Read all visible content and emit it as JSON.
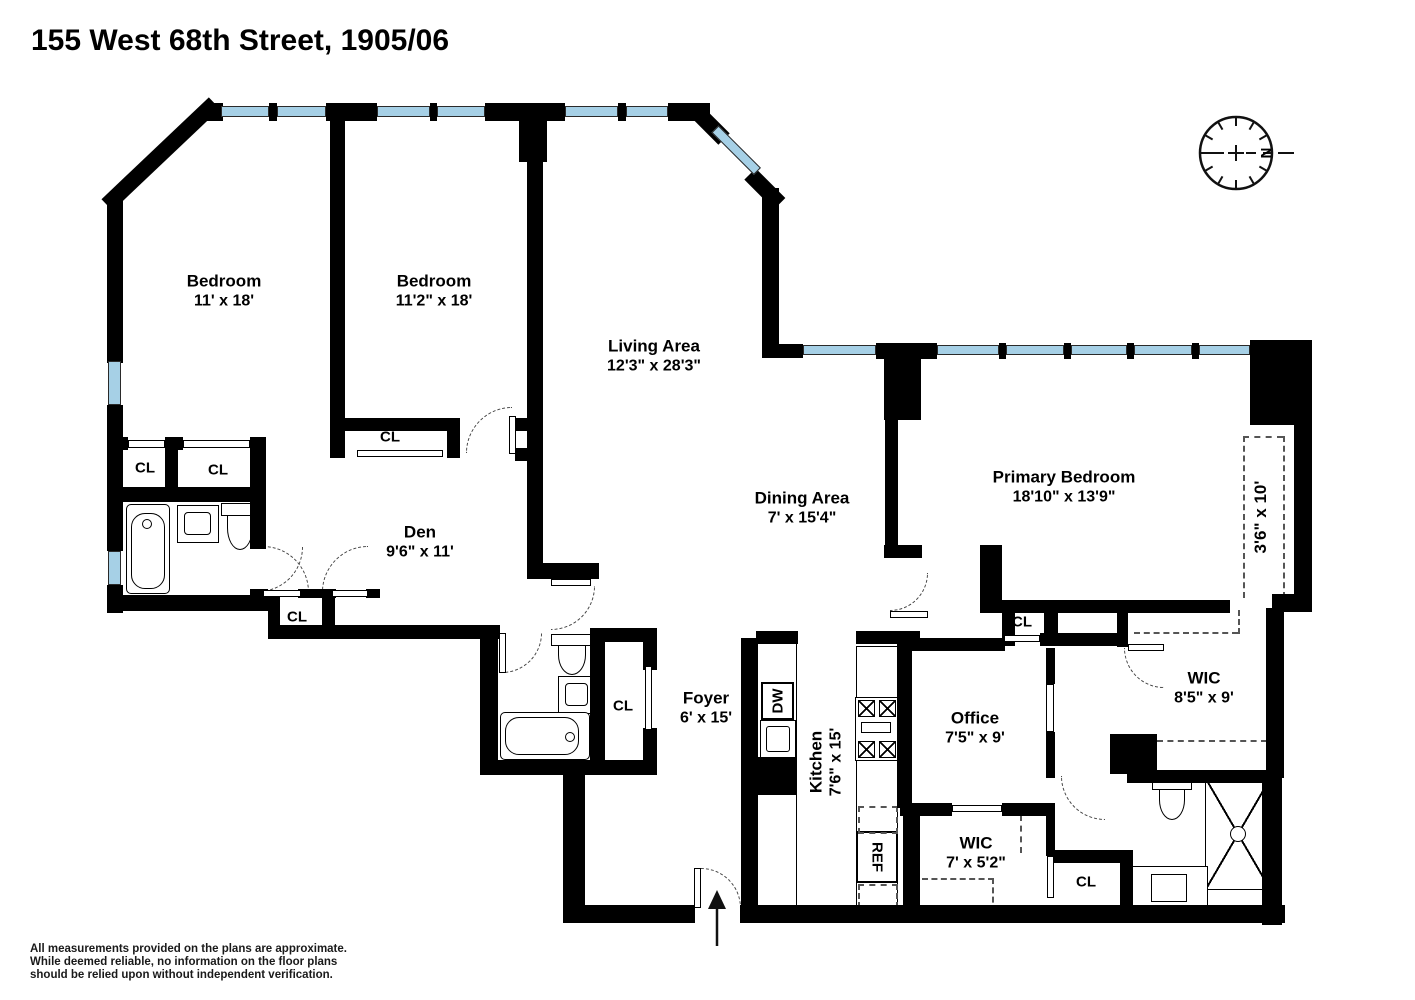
{
  "title": "155 West 68th Street, 1905/06",
  "compass": {
    "north_label": "N"
  },
  "rooms": {
    "bedroom1": {
      "name": "Bedroom",
      "dims": "11' x 18'"
    },
    "bedroom2": {
      "name": "Bedroom",
      "dims": "11'2\" x 18'"
    },
    "living": {
      "name": "Living Area",
      "dims": "12'3\" x 28'3\""
    },
    "dining": {
      "name": "Dining Area",
      "dims": "7' x 15'4\""
    },
    "primary_bedroom": {
      "name": "Primary Bedroom",
      "dims": "18'10\" x 13'9\""
    },
    "den": {
      "name": "Den",
      "dims": "9'6\" x 11'"
    },
    "foyer": {
      "name": "Foyer",
      "dims": "6' x 15'"
    },
    "kitchen": {
      "name": "Kitchen",
      "dims": "7'6\" x 15'"
    },
    "office": {
      "name": "Office",
      "dims": "7'5\" x 9'"
    },
    "wic_large": {
      "name": "WIC",
      "dims": "8'5\" x 9'"
    },
    "wic_small": {
      "name": "WIC",
      "dims": "7' x 5'2\""
    },
    "hall_closet": {
      "dims": "3'6\" x 10'"
    }
  },
  "labels": {
    "closet": "CL",
    "dishwasher": "DW",
    "refrigerator": "REF"
  },
  "disclaimer": {
    "line1": "All measurements provided on the plans are approximate.",
    "line2": "While deemed reliable, no information on the floor plans",
    "line3": "should be relied upon without independent verification."
  }
}
